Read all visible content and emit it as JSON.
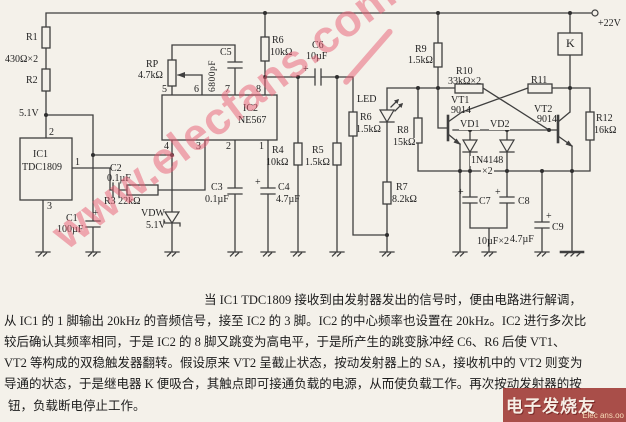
{
  "colors": {
    "ink": "#3f3f3f",
    "paper": "#f4f1ea",
    "watermark_pink": "rgba(231,91,113,0.5)",
    "badge_bg": "rgba(158,55,50,0.88)"
  },
  "watermarks": {
    "diagonal": "www.elecfans.com",
    "badge_main": "电子发烧友",
    "badge_sub": "Elec ans.oo"
  },
  "labels": {
    "plus": "+",
    "supply": "+22V",
    "r1": "R1",
    "r1v": "430Ω×2",
    "r2": "R2",
    "v51": "5.1V",
    "ic1": "IC1",
    "ic1p": "TDC1809",
    "ic1pin1": "1",
    "ic1pin2": "2",
    "ic1pin3": "3",
    "c1": "C1",
    "c1v": "100µF",
    "c2": "C2",
    "c2v": "0.1µF",
    "r3": "R3 22kΩ",
    "vdw": "VDW",
    "vdwv": "5.1V",
    "rp": "RP",
    "rpv": "4.7kΩ",
    "c5": "C5",
    "c5v": "6800pF",
    "ic2": "IC2",
    "ic2p": "NE567",
    "ic2_top": [
      "5",
      "6",
      "7",
      "8"
    ],
    "ic2_bottom": [
      "4",
      "3",
      "2",
      "1"
    ],
    "r6a": "R6",
    "r6av": "10kΩ",
    "c6": "C6",
    "c6v": "10µF",
    "c3": "C3",
    "c3v": "0.1µF",
    "c4": "C4",
    "c4v": "4.7µF",
    "r4": "R4",
    "r4v": "10kΩ",
    "r5": "R5",
    "r5v": "1.5kΩ",
    "led": "LED",
    "r6b": "R6",
    "r6bv": "1.5kΩ",
    "r8": "R8",
    "r8v": "15kΩ",
    "r7": "R7",
    "r7v": "8.2kΩ",
    "r9": "R9",
    "r9v": "1.5kΩ",
    "r10": "R10",
    "r10v": "33kΩ×2",
    "r11": "R11",
    "vt1": "VT1",
    "vt1v": "9014",
    "vt2": "VT2",
    "vt2v": "9014",
    "vd1": "VD1",
    "vd2": "VD2",
    "vdp": "1N4148",
    "vdp2": "×2",
    "c7": "C7",
    "c8": "C8",
    "c78v": "10µF×2",
    "c9": "C9",
    "c9v": "4.7µF",
    "r12": "R12",
    "r12v": "16kΩ",
    "k": "K"
  },
  "description": {
    "lines": [
      "当 IC1 TDC1809 接收到由发射器发出的信号时，便由电路进行解调，",
      "从 IC1 的 1 脚输出 20kHz 的音频信号，接至 IC2 的 3 脚。IC2 的中心频率也设置在 20kHz。IC2 进行多次比",
      "较后确认其频率相同，于是 IC2 的 8 脚又跳变为高电平，于是所产生的跳变脉冲经 C6、R6 后使 VT1、",
      "VT2 等构成的双稳触发器翻转。假设原来 VT2 呈截止状态，按动发射器上的 SA，接收机中的 VT2 则变为",
      "导通的状态，于是继电器 K 便吸合，其触点即可接通负载的电源，从而使负载工作。再次按动发射器的按",
      "钮，负载断电停止工作。"
    ]
  }
}
